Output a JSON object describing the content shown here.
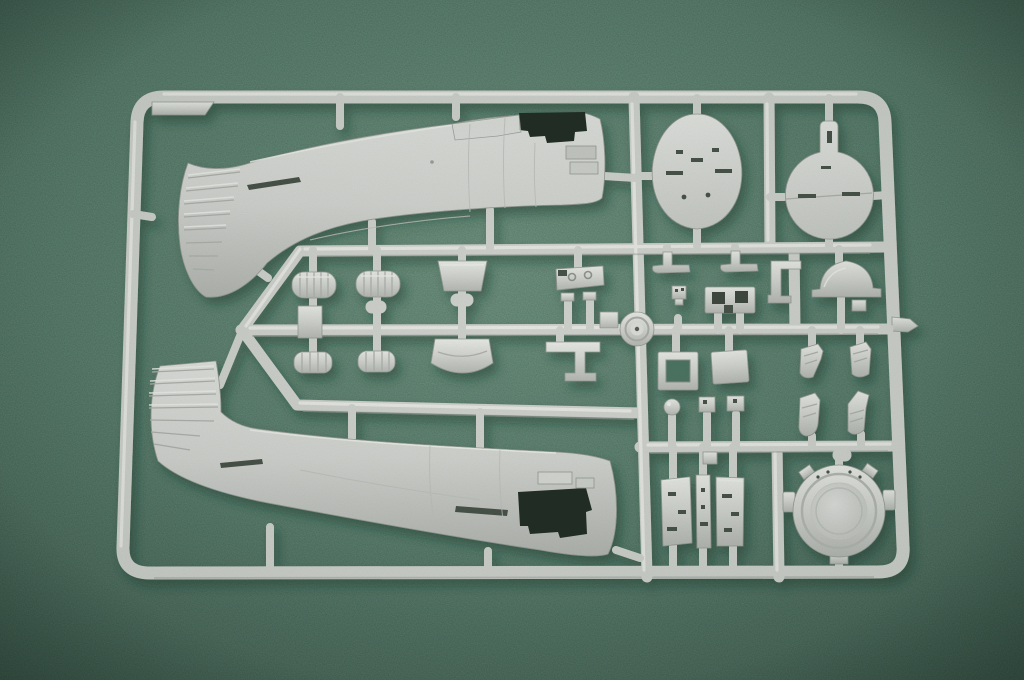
{
  "scene": {
    "subject": "plastic model kit sprue",
    "material": "light gray injection-molded styrene",
    "surface": "green felt mat"
  },
  "colors": {
    "felt": "#5a8270",
    "felt_light": "#6e9580",
    "felt_dark": "#415f51",
    "felt_shadow": "#4e7464",
    "plastic": "#cfd2cd",
    "plastic_light": "#e9ebe7",
    "plastic_shade": "#aeb1ac",
    "opening": "#232f27",
    "slot": "#49534a"
  },
  "parts": [
    {
      "name": "sprue-frame",
      "label": "rectangular sprue frame with runners"
    },
    {
      "name": "fuselage-half-upper",
      "label": "fuselage half, tail left, cockpit opening right"
    },
    {
      "name": "fuselage-half-lower",
      "label": "fuselage half, tail fin upper left, nose lower right"
    },
    {
      "name": "cowl-bulkhead",
      "label": "egg-shaped cowl bulkhead"
    },
    {
      "name": "firewall-bulkhead",
      "label": "round firewall with upper tab"
    },
    {
      "name": "engine-cowl-ring",
      "label": "round engine cowl back plate"
    },
    {
      "name": "landing-gear-doors",
      "label": "three landing gear door panels"
    },
    {
      "name": "main-wheel",
      "label": "wheel molded at runner junction"
    },
    {
      "name": "accessory-cylinders",
      "label": "ribbed cylinder pairs"
    },
    {
      "name": "seat-back",
      "label": "trapezoid seat back"
    },
    {
      "name": "cowl-flap-panel",
      "label": "curved cowl flap section"
    },
    {
      "name": "gun-sight-pedestal",
      "label": "pedestal with twin drums"
    },
    {
      "name": "exhaust-stacks",
      "label": "four angled exhaust stacks"
    },
    {
      "name": "cockpit-fittings",
      "label": "assorted small cockpit brackets and boxes"
    }
  ]
}
